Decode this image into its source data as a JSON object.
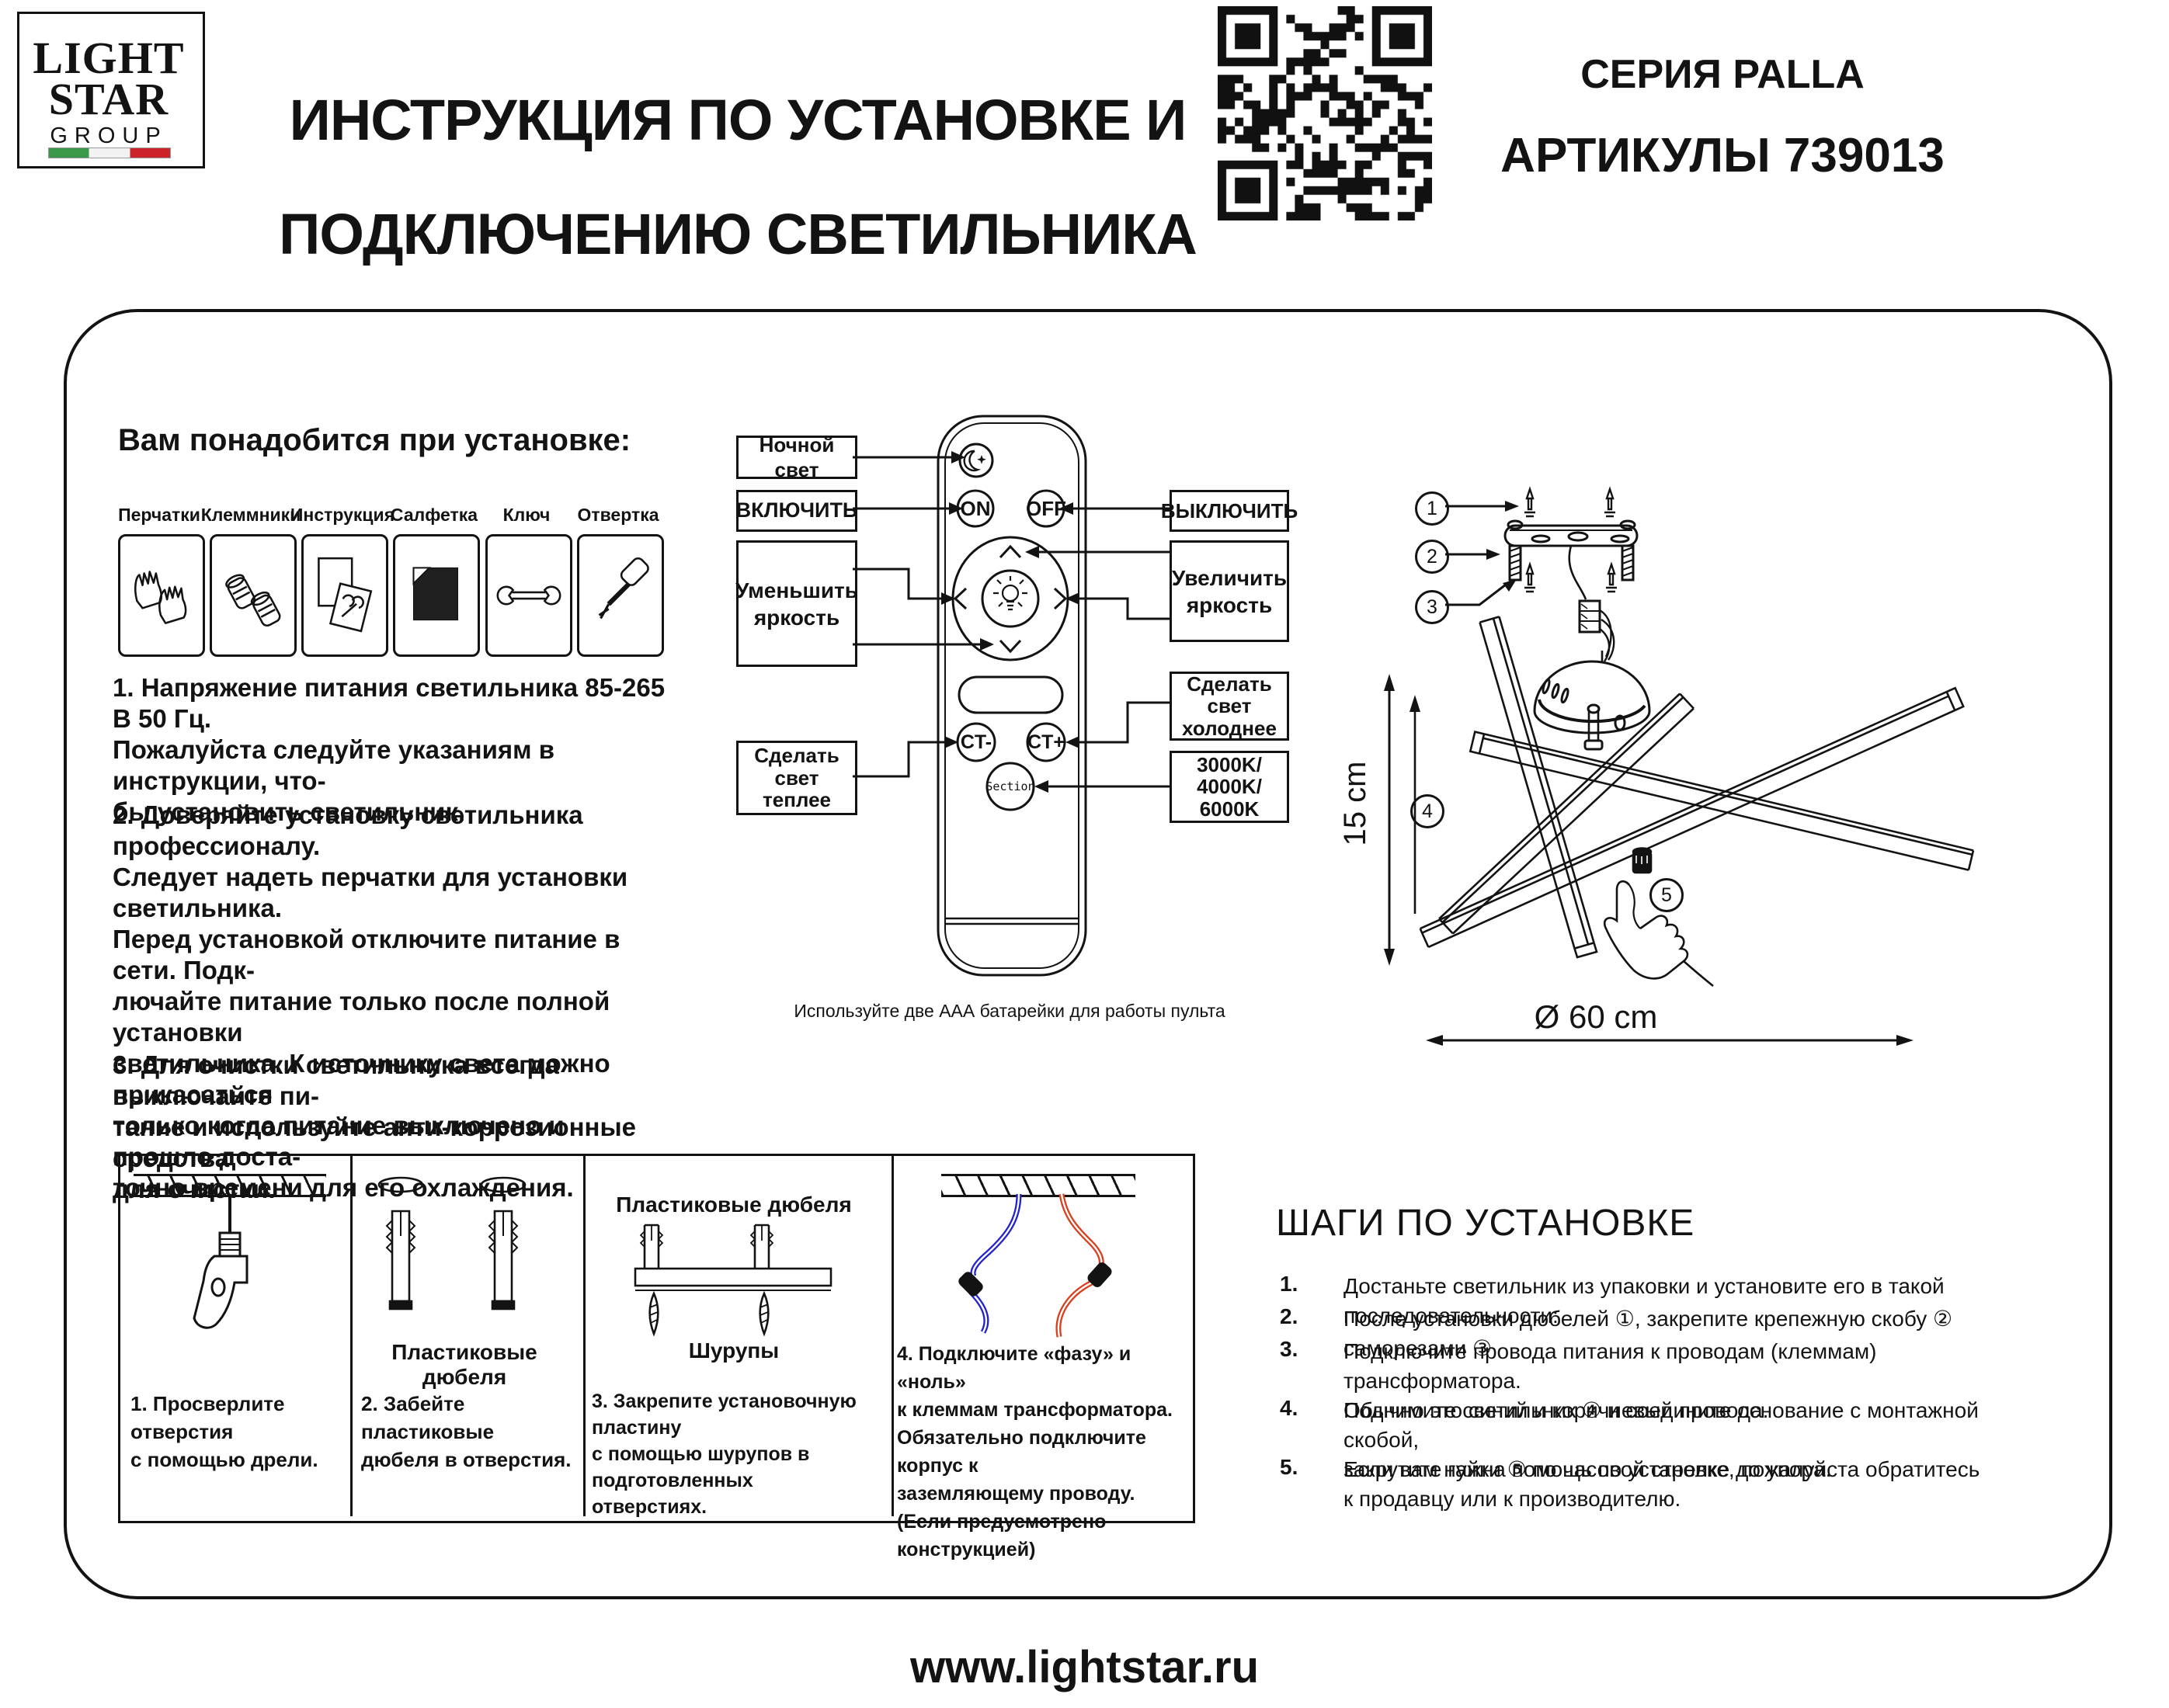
{
  "header": {
    "logo": {
      "line1": "LIGHT",
      "line2": "STAR",
      "line3": "GROUP",
      "flag_colors": [
        "#3a9948",
        "#ffffff",
        "#cc2229"
      ]
    },
    "title_line1": "ИНСТРУКЦИЯ ПО УСТАНОВКЕ И",
    "title_line2": "ПОДКЛЮЧЕНИЮ СВЕТИЛЬНИКА",
    "series": "СЕРИЯ PALLA",
    "articles": "АРТИКУЛЫ 739013",
    "qr_icon": "qr-code"
  },
  "tools": {
    "heading": "Вам понадобится при установке:",
    "items": [
      {
        "label": "Перчатки",
        "icon": "gloves-icon"
      },
      {
        "label": "Клеммники",
        "icon": "terminals-icon"
      },
      {
        "label": "Инструкция",
        "icon": "instruction-icon"
      },
      {
        "label": "Салфетка",
        "icon": "napkin-icon"
      },
      {
        "label": "Ключ",
        "icon": "wrench-icon"
      },
      {
        "label": "Отвертка",
        "icon": "screwdriver-icon"
      }
    ]
  },
  "notes": {
    "p1": "1. Напряжение питания светильника 85-265 В 50 Гц.\nПожалуйста следуйте указаниям в инструкции, что-\nбы установить светильник.",
    "p2": "2. Доверяйте установку светильника профессионалу.\nСледует надеть перчатки для установки светильника.\nПеред установкой отключите питание в сети. Подк-\nлючайте питание только после полной установки\nсветильника. К источнику света можно прикасаться\nтолько когда питание выключено и прошло доста-\nточно времени для его охлаждения.",
    "p3": "3. Для очистки светильника всегда выключайте пи-\nтание и используйте анти-коррозионные средства\nдля очистки."
  },
  "remote": {
    "buttons": {
      "night": "",
      "on": "ON",
      "off": "OFF",
      "ct_minus": "CT-",
      "ct_plus": "CT+",
      "section": "Section"
    },
    "labels": {
      "night": "Ночной свет",
      "turn_on": "ВКЛЮЧИТЬ",
      "turn_off": "ВЫКЛЮЧИТЬ",
      "dim": "Уменьшить\nяркость",
      "brighten": "Увеличить\nяркость",
      "cooler": "Сделать\nсвет\nхолоднее",
      "warmer": "Сделать\nсвет\nтеплее",
      "kelvin": "3000K/\n4000K/\n6000K"
    },
    "caption": "Используйте две ААА батарейки для работы пульта"
  },
  "diagram": {
    "callouts": [
      "1",
      "2",
      "3",
      "4",
      "5"
    ],
    "height_label": "15 cm",
    "diameter_label": "Ø 60 cm"
  },
  "panels": [
    {
      "caption": "1. Просверлите отверстия\nс помощью дрели."
    },
    {
      "label": "Пластиковые дюбеля",
      "caption": "2. Забейте пластиковые\nдюбеля в отверстия."
    },
    {
      "label_top": "Пластиковые дюбеля",
      "label_bottom": "Шурупы",
      "caption": "3. Закрепите установочную пластину\nс помощью шурупов в подготовленных\nотверстиях."
    },
    {
      "caption": "4. Подключите «фазу» и «ноль»\nк клеммам трансформатора.\nОбязательно подключите корпус к\nзаземляющему проводу.\n(Если предусмотрено конструкцией)"
    }
  ],
  "steps": {
    "heading": "ШАГИ ПО УСТАНОВКЕ",
    "items": [
      {
        "num": "1.",
        "text": "Достаньте светильник из упаковки и установите его в такой последовательности:"
      },
      {
        "num": "2.",
        "text": "После установки дюбелей ①,  закрепите крепежную скобу ②  саморезами ③"
      },
      {
        "num": "3.",
        "text": "Подключите провода питания к проводам (клеммам) трансформатора.\nОбычно это синий и коричневый провода."
      },
      {
        "num": "4.",
        "text": "Поднимите светильник ④ и соедините основание с монтажной скобой,\nзакрутите гайки ⑤ по часовой стрелке до упора."
      },
      {
        "num": "5.",
        "text": "Если вам нужна помощь по установке, пожалуйста обратитесь\nк продавцу или к производителю."
      }
    ]
  },
  "footer": {
    "website": "www.lightstar.ru"
  },
  "colors": {
    "ink": "#131313",
    "wire_blue": "#2323cc",
    "wire_red": "#d8401d",
    "flag_green": "#3a9948",
    "flag_red": "#cc2229"
  }
}
